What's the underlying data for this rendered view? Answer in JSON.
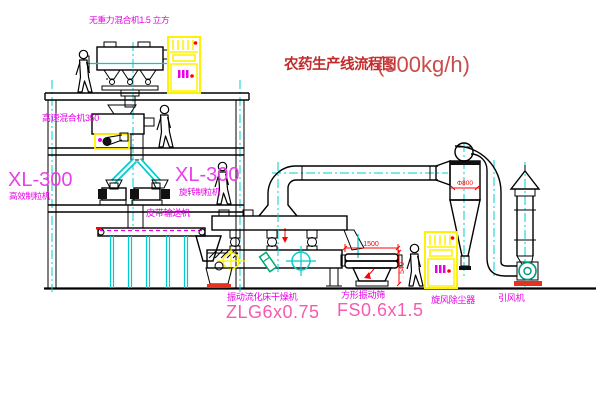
{
  "title": {
    "text_cn": "农药生产线流程图",
    "capacity": "(500kg/h)"
  },
  "equipment_labels": {
    "top_mixer": "无重力混合机1.5 立方",
    "high_speed_mixer": "高速混合机350",
    "granulator_left_model": "XL-300",
    "granulator_left_name": "高效制粒机",
    "granulator_right_model": "XL-300",
    "granulator_right_name": "旋转制粒机",
    "belt_conveyor": "皮带输送机",
    "fluid_bed_dryer_name": "振动流化床干燥机",
    "fluid_bed_dryer_model": "ZLG6x0.75",
    "vibrating_screen_name": "方形振动筛",
    "vibrating_screen_model": "FS0.6x1.5",
    "cyclone": "旋风除尘器",
    "induced_draft_fan": "引风机"
  },
  "dimensions": {
    "screen_length": "1500",
    "screen_height": "540",
    "cyclone_diameter": "Φ800"
  },
  "colors": {
    "label_magenta": "#E800E8",
    "model_pink": "#F55BB0",
    "title_red": "#C22B2B",
    "dimension_red": "#FF0000",
    "centerline_cyan": "#00CCCC",
    "cabinet_yellow": "#FFF200",
    "fan_green": "#009977"
  }
}
